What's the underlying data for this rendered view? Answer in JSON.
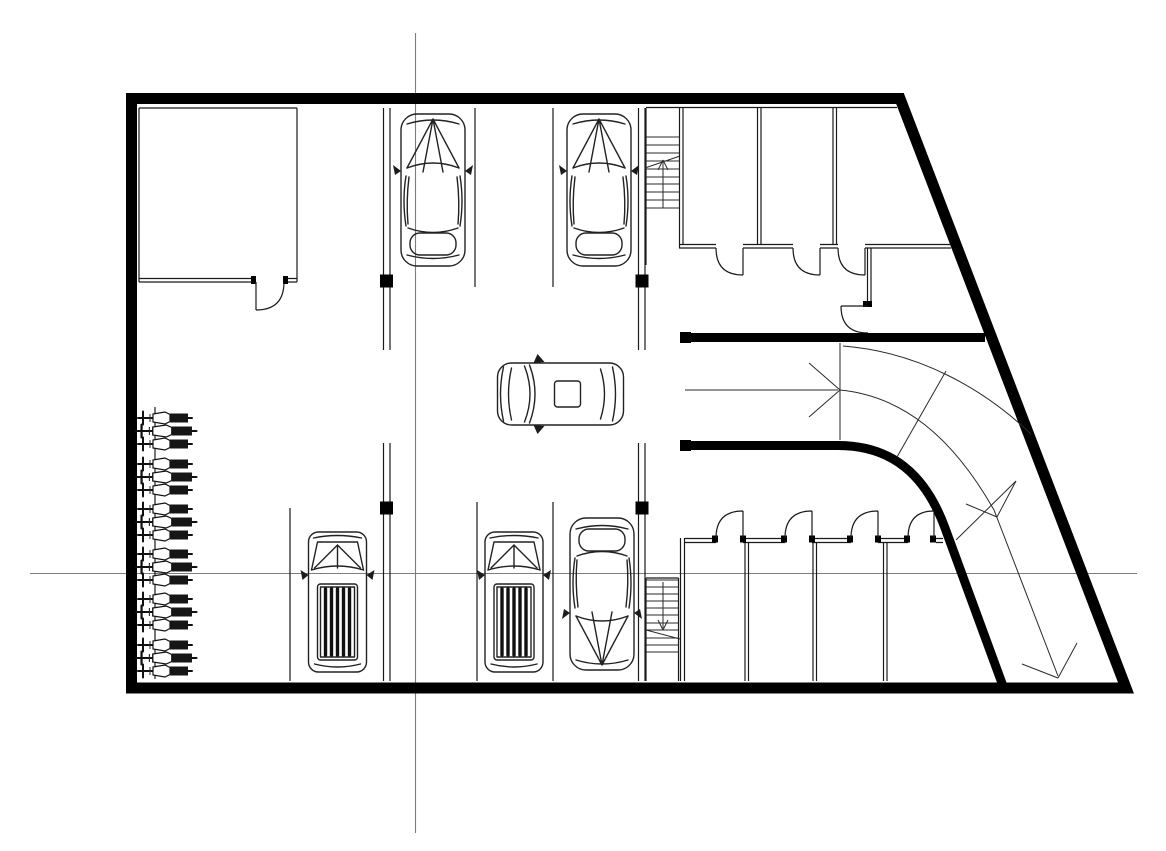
{
  "meta": {
    "title": "Basement parking garage floor plan",
    "drawing_type": "architectural-cad-floor-plan",
    "visible_text": "none"
  },
  "colors": {
    "background": "#ffffff",
    "line": "#1a1a1a",
    "wall": "#000000",
    "centerline": "#7d7d7d",
    "vehicle_dark": "#1c1c1c"
  },
  "counts": {
    "vehicles_total": 6,
    "sedans": 3,
    "suvs": 2,
    "hatchbacks": 1,
    "motorcycles": 18,
    "storage_rooms": 8,
    "swing_doors": 9,
    "stairwells": 2,
    "structural_columns": 4,
    "ramp_direction_arrows": 3,
    "parking_stalls_north_row": 3,
    "parking_stalls_south_row": 4
  },
  "icons": {
    "sedan-car-icon": "top view sedan vehicle",
    "suv-car-icon": "top view SUV with striped cargo roof",
    "hatchback-car-icon": "top view hatchback with sunroof",
    "motorcycle-icon": "top view motorcycle at rack",
    "stair-arrow-icon": "stair direction arrow",
    "ramp-arrow-icon": "drive lane direction arrow",
    "door-swing-icon": "quarter-circle door swing"
  },
  "aria": {
    "canvas": "Basement parking garage floor plan drawing",
    "building": "Building perimeter walls (trapezoidal, slanted east wall)",
    "centerlines": "Gray survey centerlines crossing the plan",
    "room_nw": "Northwest enclosed room with swing door",
    "stalls_north": "North parking stall row with two sedans",
    "stalls_south": "South parking stall row with two SUVs and a sedan",
    "stairs_north": "North stairwell with up arrow",
    "stairs_south": "South stairwell with down arrow",
    "rooms_north": "Three north storage rooms with doors and corridor",
    "rooms_south": "Four south storage rooms with doors",
    "ramp": "Curved vehicle exit ramp with direction arrows",
    "moto": "Motorcycle parking row along west wall",
    "vehicles": "Six parked vehicles",
    "aisle_car": "Hatchback driving in center aisle"
  }
}
